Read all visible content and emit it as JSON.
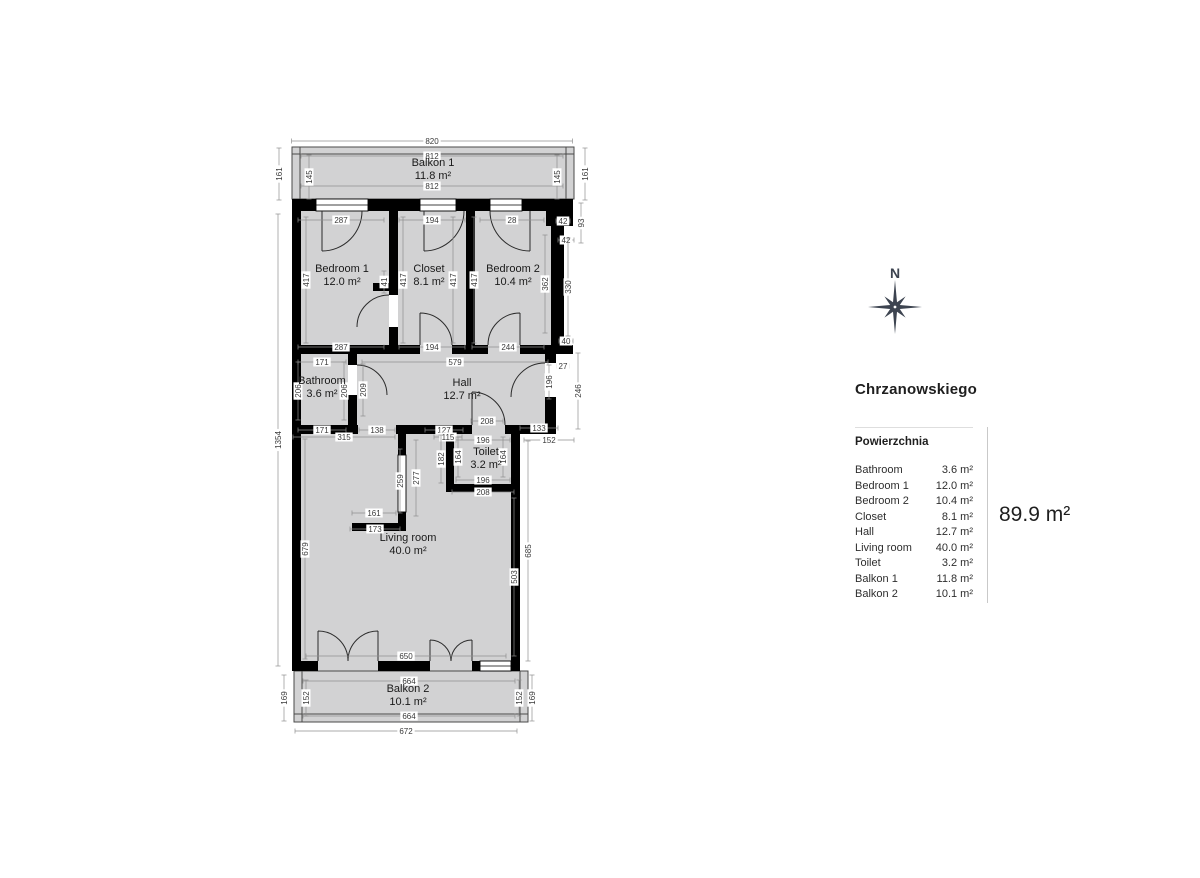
{
  "colors": {
    "room_fill": "#d2d2d3",
    "wall": "#000000",
    "dim_line": "#8f8f8f",
    "dim_text": "#3a3a3a",
    "room_text": "#1a1a1a",
    "compass": "#3d4450"
  },
  "compass": {
    "label": "N"
  },
  "legend": {
    "title": "Chrzanowskiego",
    "header": "Powierzchnia",
    "rows": [
      {
        "name": "Bathroom",
        "value": "3.6 m²"
      },
      {
        "name": "Bedroom 1",
        "value": "12.0 m²"
      },
      {
        "name": "Bedroom 2",
        "value": "10.4 m²"
      },
      {
        "name": "Closet",
        "value": "8.1 m²"
      },
      {
        "name": "Hall",
        "value": "12.7 m²"
      },
      {
        "name": "Living room",
        "value": "40.0 m²"
      },
      {
        "name": "Toilet",
        "value": "3.2 m²"
      },
      {
        "name": "Balkon 1",
        "value": "11.8 m²"
      },
      {
        "name": "Balkon 2",
        "value": "10.1 m²"
      }
    ],
    "total": "89.9 m²"
  },
  "plan": {
    "rooms": [
      {
        "name": "Balkon 1",
        "area": "11.8 m²",
        "x": 433,
        "y": 166
      },
      {
        "name": "Bedroom 1",
        "area": "12.0 m²",
        "x": 342,
        "y": 272
      },
      {
        "name": "Closet",
        "area": "8.1 m²",
        "x": 429,
        "y": 272
      },
      {
        "name": "Bedroom 2",
        "area": "10.4 m²",
        "x": 513,
        "y": 272
      },
      {
        "name": "Bathroom",
        "area": "3.6 m²",
        "x": 322,
        "y": 384
      },
      {
        "name": "Hall",
        "area": "12.7 m²",
        "x": 462,
        "y": 386
      },
      {
        "name": "Toilet",
        "area": "3.2 m²",
        "x": 486,
        "y": 455
      },
      {
        "name": "Living room",
        "area": "40.0 m²",
        "x": 408,
        "y": 541
      },
      {
        "name": "Balkon 2",
        "area": "10.1 m²",
        "x": 408,
        "y": 692
      }
    ],
    "dims": [
      {
        "t": "820",
        "x": 432,
        "y": 141,
        "o": "h",
        "l": 281
      },
      {
        "t": "812",
        "x": 432,
        "y": 156,
        "o": "h",
        "l": 262
      },
      {
        "t": "812",
        "x": 432,
        "y": 186,
        "o": "h",
        "l": 262
      },
      {
        "t": "161",
        "x": 279,
        "y": 174,
        "o": "v",
        "l": 52
      },
      {
        "t": "145",
        "x": 309,
        "y": 177,
        "o": "v",
        "l": 44
      },
      {
        "t": "145",
        "x": 557,
        "y": 177,
        "o": "v",
        "l": 44
      },
      {
        "t": "161",
        "x": 585,
        "y": 174,
        "o": "v",
        "l": 52
      },
      {
        "t": "287",
        "x": 341,
        "y": 220,
        "o": "h",
        "l": 86
      },
      {
        "t": "194",
        "x": 432,
        "y": 220,
        "o": "h",
        "l": 66
      },
      {
        "t": "28",
        "x": 512,
        "y": 220,
        "o": "h",
        "l": 64
      },
      {
        "t": "42",
        "x": 563,
        "y": 221,
        "o": "h",
        "l": 14
      },
      {
        "t": "93",
        "x": 581,
        "y": 223,
        "o": "v",
        "l": 40
      },
      {
        "t": "42",
        "x": 566,
        "y": 240,
        "o": "h",
        "l": 16
      },
      {
        "t": "417",
        "x": 306,
        "y": 280,
        "o": "v",
        "l": 126
      },
      {
        "t": "41",
        "x": 384,
        "y": 282,
        "o": "v",
        "l": 22
      },
      {
        "t": "417",
        "x": 403,
        "y": 280,
        "o": "v",
        "l": 126
      },
      {
        "t": "417",
        "x": 453,
        "y": 280,
        "o": "v",
        "l": 126
      },
      {
        "t": "417",
        "x": 474,
        "y": 280,
        "o": "v",
        "l": 126
      },
      {
        "t": "362",
        "x": 545,
        "y": 284,
        "o": "v",
        "l": 98
      },
      {
        "t": "330",
        "x": 568,
        "y": 287,
        "o": "v",
        "l": 98
      },
      {
        "t": "287",
        "x": 341,
        "y": 347,
        "o": "h",
        "l": 86
      },
      {
        "t": "194",
        "x": 432,
        "y": 347,
        "o": "h",
        "l": 66
      },
      {
        "t": "244",
        "x": 508,
        "y": 347,
        "o": "h",
        "l": 72
      },
      {
        "t": "40",
        "x": 566,
        "y": 341,
        "o": "h",
        "l": 14
      },
      {
        "t": "171",
        "x": 322,
        "y": 362,
        "o": "h",
        "l": 48
      },
      {
        "t": "579",
        "x": 455,
        "y": 362,
        "o": "h",
        "l": 186
      },
      {
        "t": "27",
        "x": 563,
        "y": 366,
        "o": "h",
        "l": 12
      },
      {
        "t": "206",
        "x": 298,
        "y": 391,
        "o": "v",
        "l": 58
      },
      {
        "t": "206",
        "x": 344,
        "y": 391,
        "o": "v",
        "l": 58
      },
      {
        "t": "209",
        "x": 363,
        "y": 390,
        "o": "v",
        "l": 52
      },
      {
        "t": "196",
        "x": 549,
        "y": 382,
        "o": "v",
        "l": 34
      },
      {
        "t": "246",
        "x": 578,
        "y": 391,
        "o": "v",
        "l": 76
      },
      {
        "t": "171",
        "x": 322,
        "y": 430,
        "o": "h",
        "l": 48
      },
      {
        "t": "138",
        "x": 377,
        "y": 430,
        "o": "h",
        "l": 36
      },
      {
        "t": "127",
        "x": 444,
        "y": 430,
        "o": "h",
        "l": 38
      },
      {
        "t": "208",
        "x": 487,
        "y": 421,
        "o": "h",
        "l": 32
      },
      {
        "t": "133",
        "x": 539,
        "y": 428,
        "o": "h",
        "l": 38
      },
      {
        "t": "315",
        "x": 344,
        "y": 437,
        "o": "h",
        "l": 102
      },
      {
        "t": "115",
        "x": 448,
        "y": 437,
        "o": "h",
        "l": 28
      },
      {
        "t": "196",
        "x": 483,
        "y": 440,
        "o": "h",
        "l": 54
      },
      {
        "t": "152",
        "x": 549,
        "y": 440,
        "o": "h",
        "l": 50
      },
      {
        "t": "182",
        "x": 441,
        "y": 459,
        "o": "v",
        "l": 48
      },
      {
        "t": "164",
        "x": 458,
        "y": 457,
        "o": "v",
        "l": 40
      },
      {
        "t": "164",
        "x": 503,
        "y": 457,
        "o": "v",
        "l": 40
      },
      {
        "t": "196",
        "x": 483,
        "y": 480,
        "o": "h",
        "l": 54
      },
      {
        "t": "208",
        "x": 483,
        "y": 492,
        "o": "h",
        "l": 62
      },
      {
        "t": "259",
        "x": 400,
        "y": 481,
        "o": "v",
        "l": 64
      },
      {
        "t": "277",
        "x": 416,
        "y": 478,
        "o": "v",
        "l": 76
      },
      {
        "t": "161",
        "x": 374,
        "y": 513,
        "o": "h",
        "l": 44
      },
      {
        "t": "173",
        "x": 375,
        "y": 529,
        "o": "h",
        "l": 50
      },
      {
        "t": "679",
        "x": 305,
        "y": 549,
        "o": "v",
        "l": 220
      },
      {
        "t": "1354",
        "x": 278,
        "y": 440,
        "o": "v",
        "l": 452
      },
      {
        "t": "685",
        "x": 528,
        "y": 551,
        "o": "v",
        "l": 220
      },
      {
        "t": "503",
        "x": 514,
        "y": 577,
        "o": "v",
        "l": 158
      },
      {
        "t": "650",
        "x": 406,
        "y": 656,
        "o": "h",
        "l": 200
      },
      {
        "t": "664",
        "x": 409,
        "y": 681,
        "o": "h",
        "l": 212
      },
      {
        "t": "664",
        "x": 409,
        "y": 716,
        "o": "h",
        "l": 212
      },
      {
        "t": "672",
        "x": 406,
        "y": 731,
        "o": "h",
        "l": 222
      },
      {
        "t": "169",
        "x": 284,
        "y": 698,
        "o": "v",
        "l": 46
      },
      {
        "t": "152",
        "x": 306,
        "y": 698,
        "o": "v",
        "l": 36
      },
      {
        "t": "152",
        "x": 519,
        "y": 698,
        "o": "v",
        "l": 36
      },
      {
        "t": "169",
        "x": 532,
        "y": 698,
        "o": "v",
        "l": 46
      }
    ]
  }
}
